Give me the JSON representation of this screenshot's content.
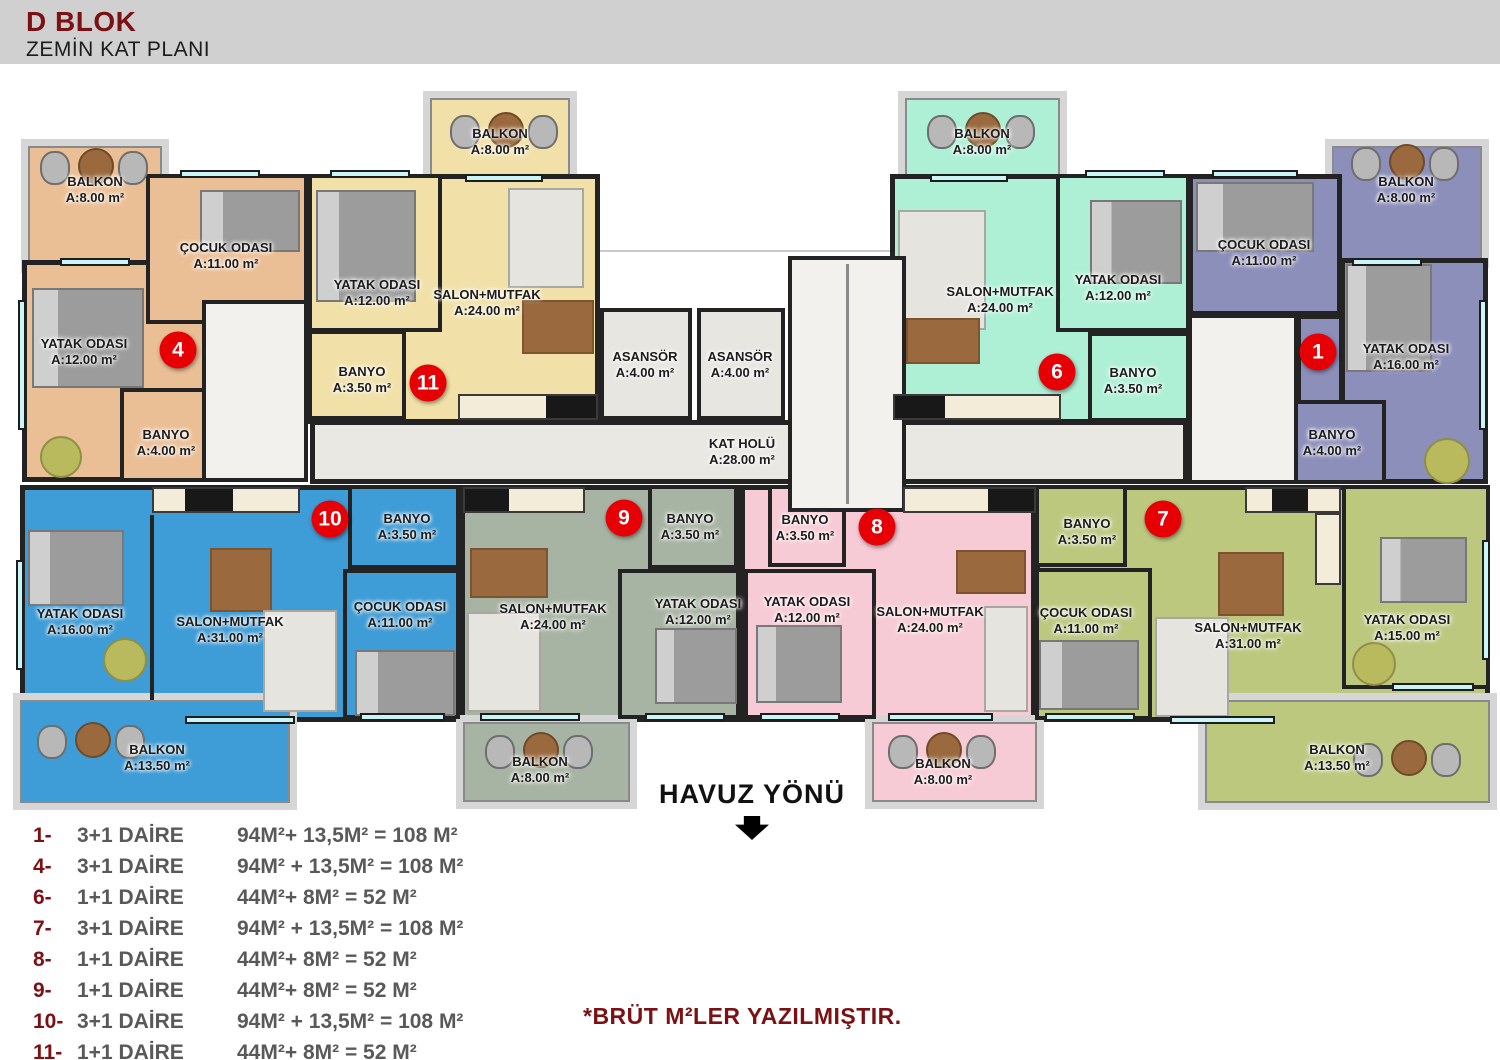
{
  "header": {
    "title": "D BLOK",
    "subtitle": "ZEMİN KAT PLANI"
  },
  "colors": {
    "unit_4_orange": "#ebbf95",
    "unit_11_yellow": "#f1e1a9",
    "unit_6_mint": "#aef0d6",
    "unit_1_purple": "#8d8fbb",
    "unit_10_blue": "#3e9cd6",
    "unit_9_sage": "#a8b4a3",
    "unit_8_pink": "#f7cbd5",
    "unit_7_olive": "#bdc87f",
    "badge_red": "#e60005",
    "accent_dark_red": "#7c1114",
    "window_cyan": "#c9f5f7",
    "wall": "#232323"
  },
  "plan": {
    "core": {
      "elevator1": {
        "name": "ASANSÖR",
        "area": "A:4.00 m²"
      },
      "elevator2": {
        "name": "ASANSÖR",
        "area": "A:4.00 m²"
      },
      "hall": {
        "name": "KAT HOLÜ",
        "area": "A:28.00 m²"
      }
    },
    "units": [
      {
        "badge": "4",
        "color": "#ebbf95",
        "rooms": [
          {
            "name": "BALKON",
            "area": "A:8.00 m²"
          },
          {
            "name": "ÇOCUK ODASI",
            "area": "A:11.00 m²"
          },
          {
            "name": "YATAK ODASI",
            "area": "A:12.00 m²"
          },
          {
            "name": "BANYO",
            "area": "A:4.00 m²"
          }
        ]
      },
      {
        "badge": "11",
        "color": "#f1e1a9",
        "rooms": [
          {
            "name": "BALKON",
            "area": "A:8.00 m²"
          },
          {
            "name": "YATAK ODASI",
            "area": "A:12.00 m²"
          },
          {
            "name": "SALON+MUTFAK",
            "area": "A:24.00 m²"
          },
          {
            "name": "BANYO",
            "area": "A:3.50 m²"
          }
        ]
      },
      {
        "badge": "6",
        "color": "#aef0d6",
        "rooms": [
          {
            "name": "BALKON",
            "area": "A:8.00 m²"
          },
          {
            "name": "SALON+MUTFAK",
            "area": "A:24.00 m²"
          },
          {
            "name": "YATAK ODASI",
            "area": "A:12.00 m²"
          },
          {
            "name": "BANYO",
            "area": "A:3.50 m²"
          }
        ]
      },
      {
        "badge": "1",
        "color": "#8d8fbb",
        "rooms": [
          {
            "name": "BALKON",
            "area": "A:8.00 m²"
          },
          {
            "name": "ÇOCUK ODASI",
            "area": "A:11.00 m²"
          },
          {
            "name": "YATAK ODASI",
            "area": "A:16.00 m²"
          },
          {
            "name": "BANYO",
            "area": "A:4.00 m²"
          }
        ]
      },
      {
        "badge": "10",
        "color": "#3e9cd6",
        "rooms": [
          {
            "name": "YATAK ODASI",
            "area": "A:16.00 m²"
          },
          {
            "name": "SALON+MUTFAK",
            "area": "A:31.00 m²"
          },
          {
            "name": "BANYO",
            "area": "A:3.50 m²"
          },
          {
            "name": "ÇOCUK ODASI",
            "area": "A:11.00 m²"
          },
          {
            "name": "BALKON",
            "area": "A:13.50 m²"
          }
        ]
      },
      {
        "badge": "9",
        "color": "#a8b4a3",
        "rooms": [
          {
            "name": "BANYO",
            "area": "A:3.50 m²"
          },
          {
            "name": "SALON+MUTFAK",
            "area": "A:24.00 m²"
          },
          {
            "name": "YATAK ODASI",
            "area": "A:12.00 m²"
          },
          {
            "name": "BALKON",
            "area": "A:8.00 m²"
          }
        ]
      },
      {
        "badge": "8",
        "color": "#f7cbd5",
        "rooms": [
          {
            "name": "BANYO",
            "area": "A:3.50 m²"
          },
          {
            "name": "YATAK ODASI",
            "area": "A:12.00 m²"
          },
          {
            "name": "SALON+MUTFAK",
            "area": "A:24.00 m²"
          },
          {
            "name": "BALKON",
            "area": "A:8.00 m²"
          }
        ]
      },
      {
        "badge": "7",
        "color": "#bdc87f",
        "rooms": [
          {
            "name": "BANYO",
            "area": "A:3.50 m²"
          },
          {
            "name": "ÇOCUK ODASI",
            "area": "A:11.00 m²"
          },
          {
            "name": "SALON+MUTFAK",
            "area": "A:31.00 m²"
          },
          {
            "name": "YATAK ODASI",
            "area": "A:15.00 m²"
          },
          {
            "name": "BALKON",
            "area": "A:13.50 m²"
          }
        ]
      }
    ]
  },
  "pool": {
    "label": "HAVUZ YÖNÜ"
  },
  "legend": {
    "rows": [
      {
        "num": "1-",
        "type": "3+1 DAİRE",
        "calc": "94M²+ 13,5M² = 108 M²"
      },
      {
        "num": "4-",
        "type": "3+1 DAİRE",
        "calc": "94M² + 13,5M² = 108 M²"
      },
      {
        "num": "6-",
        "type": "1+1 DAİRE",
        "calc": "44M²+ 8M² = 52 M²"
      },
      {
        "num": "7-",
        "type": "3+1 DAİRE",
        "calc": "94M² + 13,5M² = 108 M²"
      },
      {
        "num": "8-",
        "type": "1+1 DAİRE",
        "calc": "44M²+ 8M² = 52 M²"
      },
      {
        "num": "9-",
        "type": "1+1 DAİRE",
        "calc": "44M²+ 8M² = 52 M²"
      },
      {
        "num": "10-",
        "type": "3+1 DAİRE",
        "calc": "94M² + 13,5M² = 108 M²"
      },
      {
        "num": "11-",
        "type": "1+1 DAİRE",
        "calc": "44M²+ 8M² = 52 M²"
      }
    ]
  },
  "note": {
    "text": "*BRÜT M²LER YAZILMIŞTIR."
  }
}
